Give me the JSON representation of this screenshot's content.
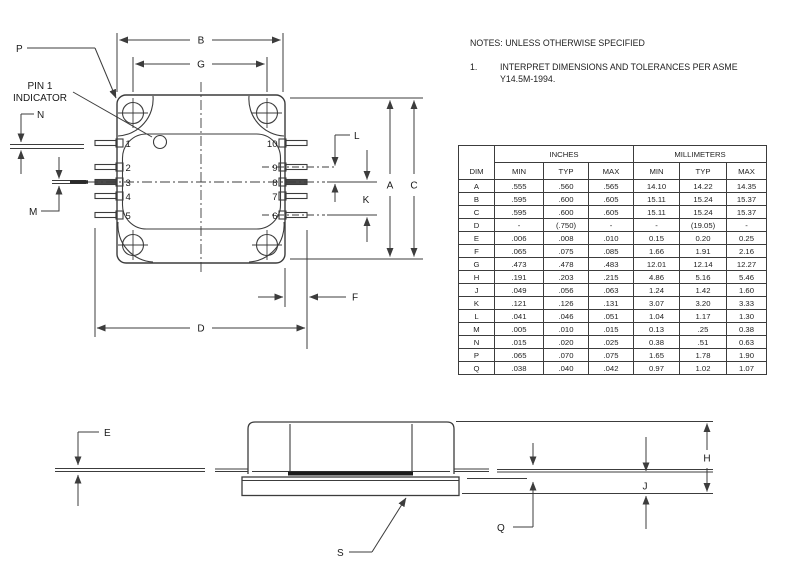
{
  "notes": {
    "title": "NOTES: UNLESS OTHERWISE SPECIFIED",
    "items": [
      {
        "num": "1.",
        "line1": "INTERPRET DIMENSIONS AND TOLERANCES PER ASME",
        "line2": "Y14.5M-1994."
      }
    ]
  },
  "table": {
    "col_dim": "DIM",
    "group_inches": "INCHES",
    "group_mm": "MILLIMETERS",
    "sub": [
      "MIN",
      "TYP",
      "MAX",
      "MIN",
      "TYP",
      "MAX"
    ],
    "rows": [
      {
        "dim": "A",
        "in_min": ".555",
        "in_typ": ".560",
        "in_max": ".565",
        "mm_min": "14.10",
        "mm_typ": "14.22",
        "mm_max": "14.35"
      },
      {
        "dim": "B",
        "in_min": ".595",
        "in_typ": ".600",
        "in_max": ".605",
        "mm_min": "15.11",
        "mm_typ": "15.24",
        "mm_max": "15.37"
      },
      {
        "dim": "C",
        "in_min": ".595",
        "in_typ": ".600",
        "in_max": ".605",
        "mm_min": "15.11",
        "mm_typ": "15.24",
        "mm_max": "15.37"
      },
      {
        "dim": "D",
        "in_min": "-",
        "in_typ": "(.750)",
        "in_max": "-",
        "mm_min": "-",
        "mm_typ": "(19.05)",
        "mm_max": "-"
      },
      {
        "dim": "E",
        "in_min": ".006",
        "in_typ": ".008",
        "in_max": ".010",
        "mm_min": "0.15",
        "mm_typ": "0.20",
        "mm_max": "0.25"
      },
      {
        "dim": "F",
        "in_min": ".065",
        "in_typ": ".075",
        "in_max": ".085",
        "mm_min": "1.66",
        "mm_typ": "1.91",
        "mm_max": "2.16"
      },
      {
        "dim": "G",
        "in_min": ".473",
        "in_typ": ".478",
        "in_max": ".483",
        "mm_min": "12.01",
        "mm_typ": "12.14",
        "mm_max": "12.27"
      },
      {
        "dim": "H",
        "in_min": ".191",
        "in_typ": ".203",
        "in_max": ".215",
        "mm_min": "4.86",
        "mm_typ": "5.16",
        "mm_max": "5.46"
      },
      {
        "dim": "J",
        "in_min": ".049",
        "in_typ": ".056",
        "in_max": ".063",
        "mm_min": "1.24",
        "mm_typ": "1.42",
        "mm_max": "1.60"
      },
      {
        "dim": "K",
        "in_min": ".121",
        "in_typ": ".126",
        "in_max": ".131",
        "mm_min": "3.07",
        "mm_typ": "3.20",
        "mm_max": "3.33"
      },
      {
        "dim": "L",
        "in_min": ".041",
        "in_typ": ".046",
        "in_max": ".051",
        "mm_min": "1.04",
        "mm_typ": "1.17",
        "mm_max": "1.30"
      },
      {
        "dim": "M",
        "in_min": ".005",
        "in_typ": ".010",
        "in_max": ".015",
        "mm_min": "0.13",
        "mm_typ": ".25",
        "mm_max": "0.38"
      },
      {
        "dim": "N",
        "in_min": ".015",
        "in_typ": ".020",
        "in_max": ".025",
        "mm_min": "0.38",
        "mm_typ": ".51",
        "mm_max": "0.63"
      },
      {
        "dim": "P",
        "in_min": ".065",
        "in_typ": ".070",
        "in_max": ".075",
        "mm_min": "1.65",
        "mm_typ": "1.78",
        "mm_max": "1.90"
      },
      {
        "dim": "Q",
        "in_min": ".038",
        "in_typ": ".040",
        "in_max": ".042",
        "mm_min": "0.97",
        "mm_typ": "1.02",
        "mm_max": "1.07"
      }
    ]
  },
  "top_view": {
    "labels": {
      "p": "P",
      "pin1_a": "PIN 1",
      "pin1_b": "INDICATOR",
      "n": "N",
      "m": "M",
      "b": "B",
      "g": "G",
      "a": "A",
      "c": "C",
      "d": "D",
      "f": "F",
      "k": "K",
      "l": "L"
    },
    "pins_left": [
      "1",
      "2",
      "3",
      "4",
      "5"
    ],
    "pins_right": [
      "10",
      "9",
      "8",
      "7",
      "6"
    ]
  },
  "side_view": {
    "labels": {
      "e": "E",
      "s": "S",
      "q": "Q",
      "j": "J",
      "h": "H"
    }
  },
  "colors": {
    "line": "#3c3c3c",
    "text": "#1a1a1a",
    "background": "#ffffff",
    "lead_fill": "#4a4a4a"
  }
}
